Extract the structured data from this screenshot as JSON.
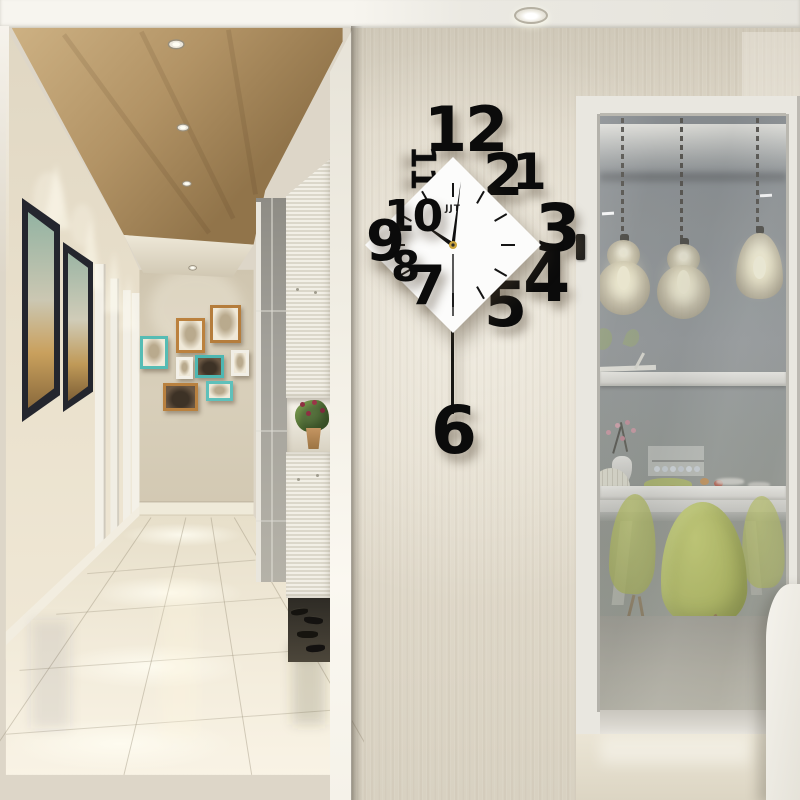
{
  "scene": {
    "description": "Bright modern hallway with wood-panel ceiling, spotlights, black framed pictures, colorful gallery wall, white louvered hall cabinet with plant niche and shoes, glossy cream tile floor. On the beige feature wall hangs a designer pendulum wall clock: a white diamond face with scattered black acrylic numerals and a pendulum '6'. At right, a grey glass partition shows a dining room with lantern pendant lamps, white table and lime green shell chairs.",
    "style": "interior product lifestyle photo"
  },
  "clock": {
    "brand": "JJT",
    "reading": "approx 10:01",
    "numerals": {
      "n1": "1",
      "n2": "2",
      "n3": "3",
      "n4": "4",
      "n5": "5",
      "n6": "6",
      "n7": "7",
      "n8": "8",
      "n9": "9",
      "n10": "10",
      "n11": "11",
      "n12": "12"
    },
    "time": {
      "hour_transform": "rotate(-55 95 97)",
      "minute_transform": "rotate(7 95 97)",
      "second_transform": "rotate(180 95 97)"
    }
  },
  "colors": {
    "numerals": "#0b0b0b",
    "clock_face": "#fcfcfb",
    "center_pin": "#caa43c",
    "feature_wall": "#dcd5c6",
    "wood_ceiling": "#b39565",
    "hall_wall": "#e8e0cd",
    "floor": "#f0e8d6",
    "gallery_teal": "#56bcb4",
    "gallery_orange": "#bb813e",
    "dark_frame": "#24262e",
    "glass": "#8a8f92",
    "chair_green": "#b5bf58",
    "lamp_shade": "#c8bfa4"
  }
}
